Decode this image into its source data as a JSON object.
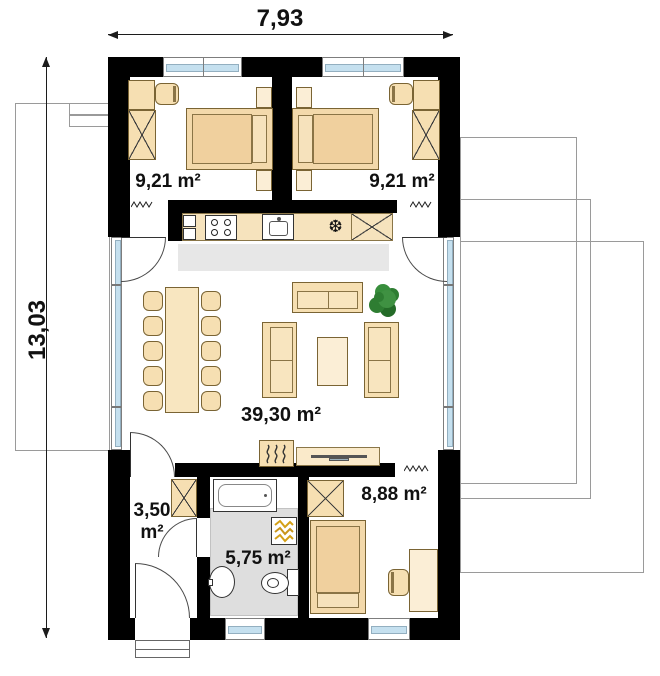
{
  "dimensions": {
    "width_label": "7,93",
    "height_label": "13,03"
  },
  "rooms": {
    "bedroom_left": {
      "area_label": "9,21 m²"
    },
    "bedroom_right": {
      "area_label": "9,21 m²"
    },
    "living_room": {
      "area_label": "39,30 m²"
    },
    "hall": {
      "area_label_line1": "3,50",
      "area_label_line2": "m²"
    },
    "bathroom": {
      "area_label": "5,75 m²"
    },
    "bedroom_small": {
      "area_label": "8,88 m²"
    }
  },
  "icons": {
    "fridge_snowflake": "❆"
  },
  "colors": {
    "wall": "#000000",
    "furniture": "#f6dfb2",
    "furniture_light": "#fbeed6",
    "window_glass": "#c5e0ef",
    "floor_gray": "#e7e7e7",
    "outline_gray": "#9a9a9a",
    "plant_green": "#2e7d32",
    "radiator_gold": "#d4a017"
  }
}
